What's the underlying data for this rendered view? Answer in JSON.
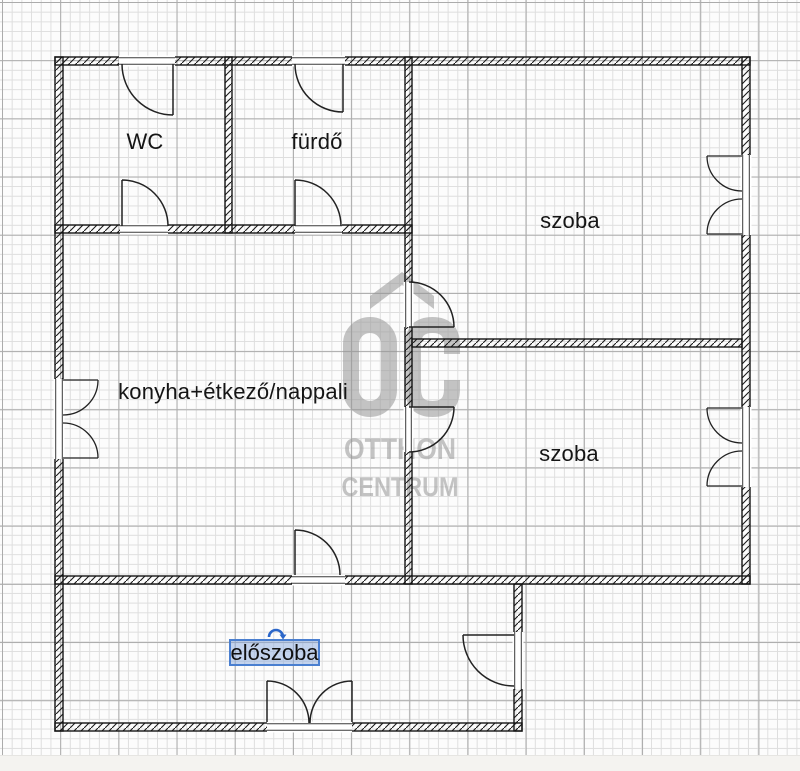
{
  "floor_plan": {
    "labels": {
      "wc": "WC",
      "bathroom": "fürdő",
      "room_top": "szoba",
      "kitchen": "konyha+étkező/nappali",
      "room_middle": "szoba",
      "hallway": "előszoba"
    },
    "selection": {
      "selected_label": "előszoba",
      "border_color": "#4a7fd0",
      "fill_color": "rgba(137,170,222,0.5)",
      "handle_color": "#2b66c9"
    },
    "watermark": {
      "logo": "OC",
      "line1": "OTTHON",
      "line2": "CENTRUM",
      "color": "#969696"
    },
    "colors": {
      "wall": "#141414",
      "grid_minor": "#dedede",
      "grid_major": "#ababab",
      "background": "#fcfcfc"
    }
  }
}
